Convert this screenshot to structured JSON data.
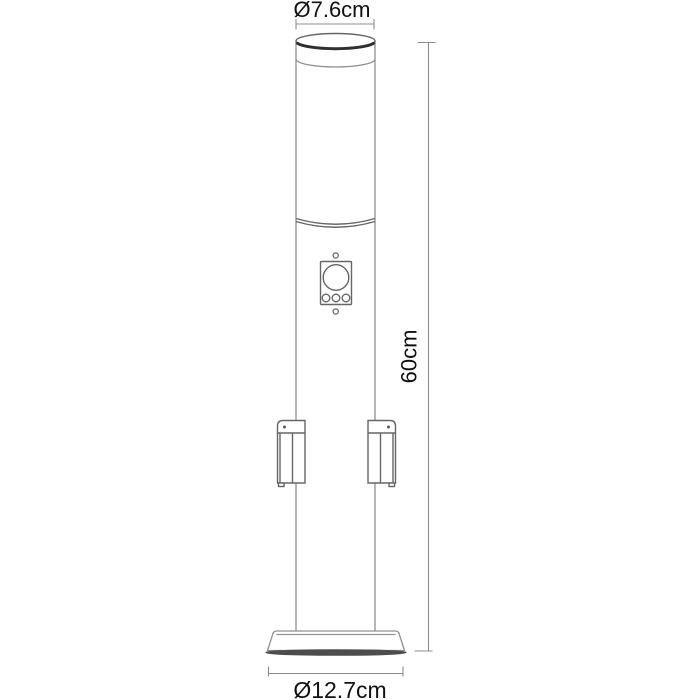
{
  "diagram": {
    "title": "bollard light dimension drawing",
    "background_color": "#ffffff",
    "line_color": "#8f8f8f",
    "detail_line_color": "#666666",
    "thick_rim_color": "#2f2f2f",
    "dimension_line_color": "#8c8c8c",
    "text_color": "#111111",
    "labels": {
      "top_diameter": "Ø7.6cm",
      "height": "60cm",
      "base_diameter": "Ø12.7cm"
    }
  }
}
